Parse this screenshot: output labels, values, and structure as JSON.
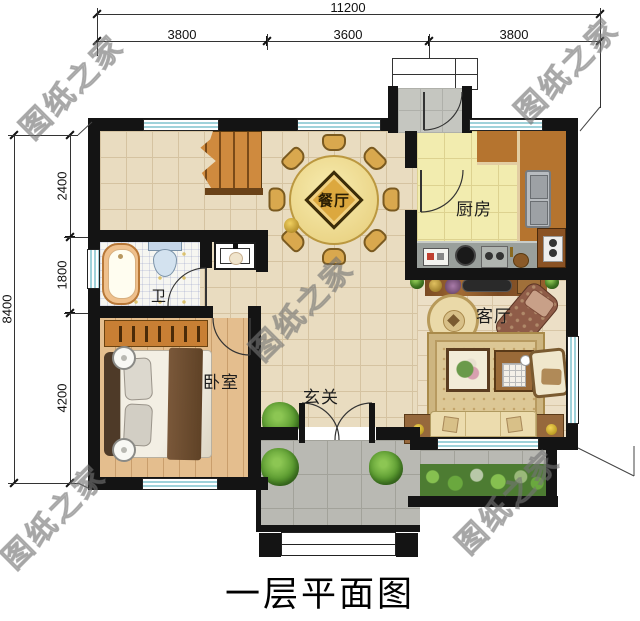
{
  "title": "一层平面图",
  "watermark": "图纸之家",
  "dimensions": {
    "top_total": "11200",
    "top_segments": [
      "3800",
      "3600",
      "3800"
    ],
    "left_total": "8400",
    "left_segments": [
      "2400",
      "1800",
      "4200"
    ]
  },
  "rooms": {
    "dining": "餐厅",
    "kitchen": "厨房",
    "bathroom": "卫",
    "living": "客厅",
    "bedroom": "卧室",
    "foyer": "玄关"
  },
  "colors": {
    "wall": "#141414",
    "hall_floor": "#e9dcc0",
    "kitchen_floor": "#f2ecaf",
    "bedroom_floor": "#e4be8e",
    "bathroom_floor": "#f6f6f1",
    "porch_floor": "#b9b9b3",
    "window_glass": "#9fd2da",
    "counter_wood": "#b5742f",
    "dining_table": "#f0dc82",
    "sofa": "#ecdcae",
    "watermark_gray": "#828282"
  }
}
